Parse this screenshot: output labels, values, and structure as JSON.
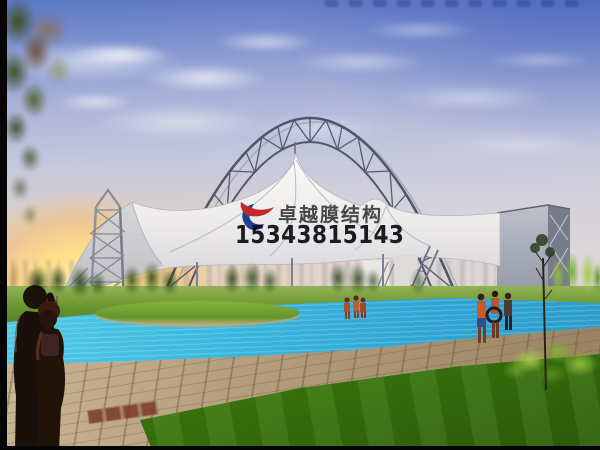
{
  "image": {
    "type": "architectural rendering photo",
    "subject": "Arched steel lattice truss with white tensile membrane canopy over a swimming pool plaza at sunset",
    "elements": [
      "blue sky with cirrus clouds",
      "sunset glow on left horizon",
      "faint city skyline",
      "arched lattice steel truss",
      "lattice mast tower",
      "white membrane canopy with twin peaks",
      "grey end-wall structure",
      "inclined lattice struts",
      "row of poplar trees",
      "turquoise swimming pool",
      "grass island",
      "paved stone walkway",
      "green lawn",
      "shrubs and conifers",
      "sapling tree",
      "three swimmers mid-pool",
      "three swimmers at right pool edge",
      "two foreground onlookers",
      "overhanging tree branch top-left"
    ]
  },
  "watermark": {
    "brand_text": "卓越膜结构",
    "phone_number": "15343815143",
    "logo_icon": "red-blue-phoenix-swoosh",
    "brand_text_color": "#28282e",
    "phone_text_color": "#0e0e14",
    "logo_red": "#c3272b",
    "logo_blue": "#1f3f8f"
  },
  "palette": {
    "sky_top": "#5b76c4",
    "sky_horizon": "#e2d8d2",
    "sunset_glow": "#ffe08a",
    "pool_water": "#35b2da",
    "lawn_green": "#63a317",
    "walkway_tan": "#b5a080",
    "membrane_white": "#f3f2f0",
    "steel_grey": "#4e5668"
  }
}
